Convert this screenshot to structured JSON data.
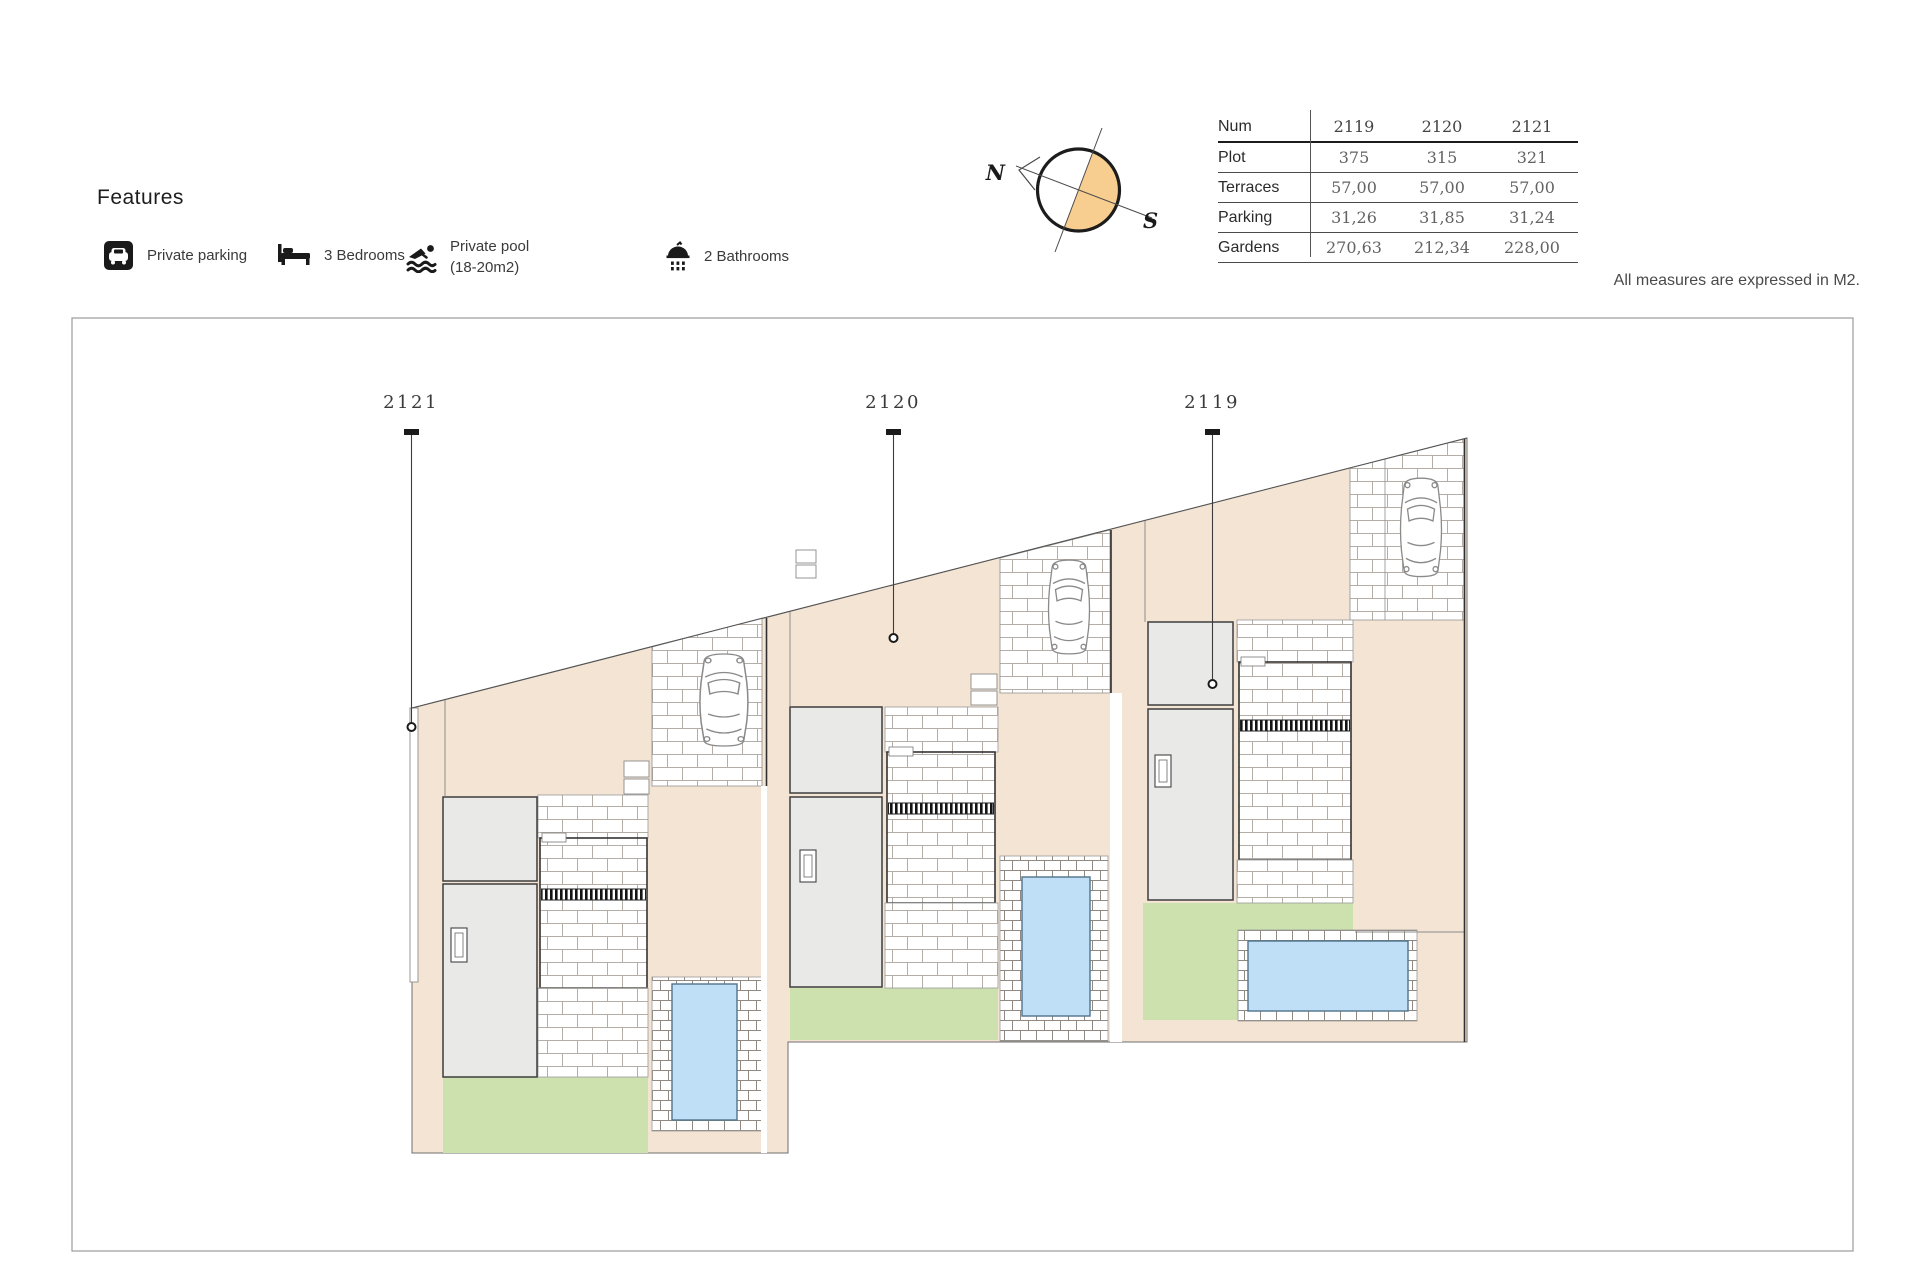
{
  "features": {
    "title": "Features",
    "items": [
      {
        "icon": "parking-icon",
        "label": "Private parking"
      },
      {
        "icon": "bed-icon",
        "label": "3 Bedrooms"
      },
      {
        "icon": "pool-icon",
        "label_line1": "Private pool",
        "label_line2": "(18-20m2)"
      },
      {
        "icon": "shower-icon",
        "label": "2 Bathrooms"
      }
    ]
  },
  "compass": {
    "north": "N",
    "south": "S"
  },
  "table": {
    "header_label": "Num",
    "columns": [
      "2119",
      "2120",
      "2121"
    ],
    "rows": [
      {
        "label": "Plot",
        "values": [
          "375",
          "315",
          "321"
        ]
      },
      {
        "label": "Terraces",
        "values": [
          "57,00",
          "57,00",
          "57,00"
        ]
      },
      {
        "label": "Parking",
        "values": [
          "31,26",
          "31,85",
          "31,24"
        ]
      },
      {
        "label": "Gardens",
        "values": [
          "270,63",
          "212,34",
          "228,00"
        ]
      }
    ]
  },
  "note": "All measures are expressed in M2.",
  "plan": {
    "labels": [
      "2121",
      "2120",
      "2119"
    ],
    "colors": {
      "ground": "#F4E4D3",
      "garden": "#CCE1AE",
      "pool": "#BEDFF5",
      "building": "#E9EAE8",
      "compass_fill": "#F7CE8F"
    }
  }
}
